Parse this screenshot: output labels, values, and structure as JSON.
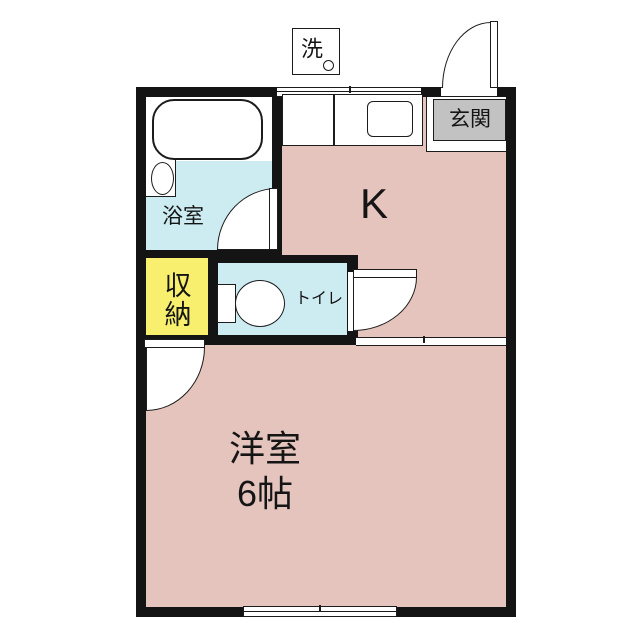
{
  "plan": {
    "labels": {
      "washer": "洗",
      "entrance": "玄関",
      "kitchen": "K",
      "bathroom": "浴室",
      "storage_line1": "収",
      "storage_line2": "納",
      "toilet": "トイレ",
      "room_name": "洋室",
      "room_size": "6帖"
    },
    "colors": {
      "room_pink": "#e4c4bc",
      "wet_blue": "#cdecf2",
      "storage_yellow": "#f7ef6d",
      "entrance_gray": "#c2c2c2",
      "wall": "#141414",
      "line": "#1c1c1c",
      "bg": "#ffffff"
    }
  }
}
